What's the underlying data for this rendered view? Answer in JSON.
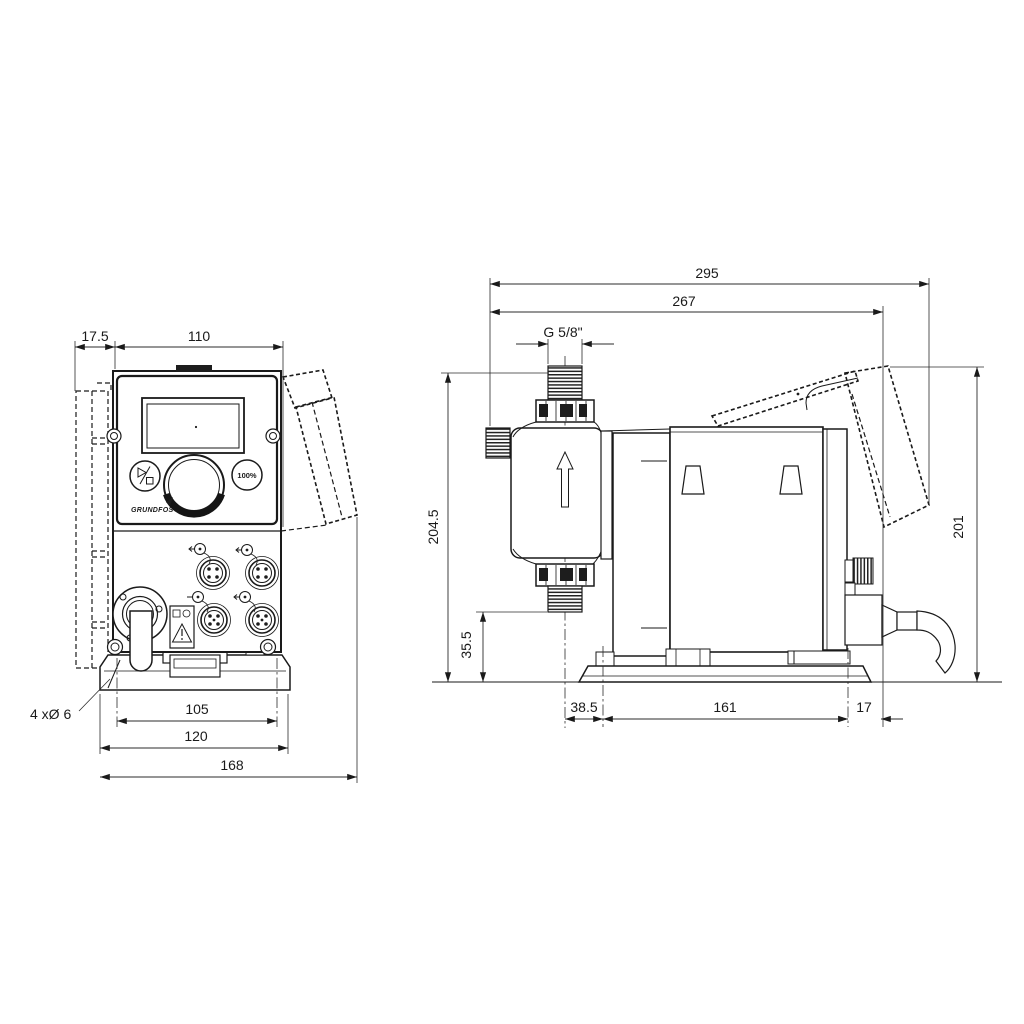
{
  "front": {
    "dims": {
      "offset": "17.5",
      "width": "110",
      "holes": "4 xØ 6",
      "hole_spacing": "105",
      "plate_width": "120",
      "overall_width": "168"
    },
    "capacity_button": "100%",
    "brand": "GRUNDFOS"
  },
  "side": {
    "dims": {
      "overall_depth": "295",
      "bracket_depth": "267",
      "thread": "G 5/8\"",
      "overall_height": "204.5",
      "outlet_height": "35.5",
      "head_offset": "38.5",
      "hole_spacing": "161",
      "rear_offset": "17",
      "bracket_height": "201"
    }
  }
}
